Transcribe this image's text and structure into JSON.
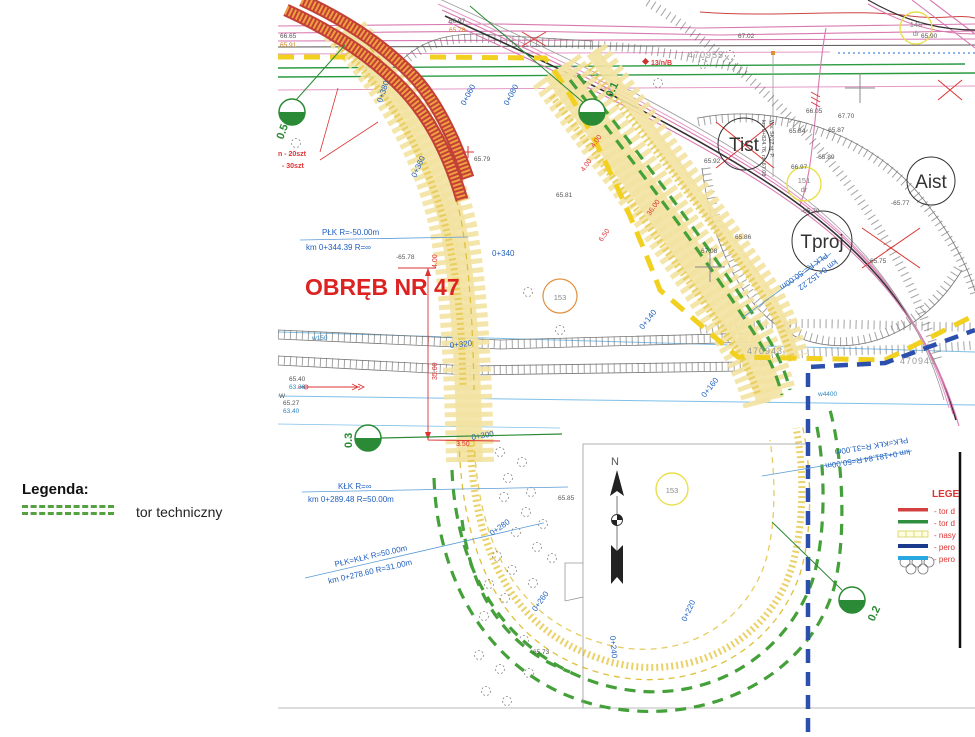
{
  "legend_left": {
    "title": "Legenda:",
    "item": "tor techniczny",
    "line_color": "#55a040"
  },
  "legend_box": {
    "title": "LEGE",
    "entries": [
      {
        "label": "- tor d",
        "color": "#d34040"
      },
      {
        "label": "- tor d",
        "color": "#2f8f3f"
      },
      {
        "label": "- nasy",
        "color": "#e8e04a"
      },
      {
        "label": "- pero",
        "color": "#1a3a8c"
      },
      {
        "label": "- pero",
        "color": "#28a8e0"
      }
    ]
  },
  "map": {
    "region_label": "OBRĘB NR 47",
    "north_label": "N",
    "curve_notes": [
      {
        "l1": "PŁK   R=-50.00m",
        "l2": "km 0+344.39   R=∞"
      },
      {
        "l1": "KŁK   R=∞",
        "l2": "km 0+289.48   R=50.00m"
      },
      {
        "l1": "PŁK=KŁK   R=50.00m",
        "l2": "km 0+278.60   R=31.00m"
      },
      {
        "l1": "PŁK=KŁK   R=31.00m",
        "l2": "km 0+181.84   R=50.00m"
      },
      {
        "l1": "PŁK   R=-50.00m",
        "l2": "km 0+152.22"
      }
    ],
    "chainages": [
      "0+380",
      "0+360",
      "0+340",
      "0+320",
      "0+300",
      "0+280",
      "0+260",
      "0+240",
      "0+220",
      "0+160",
      "0+140",
      "0+080",
      "0+060"
    ],
    "markers": [
      "0.5",
      "0.1",
      "0.3",
      "0.2"
    ],
    "big_circles": [
      "Tist",
      "Aist",
      "Tproj"
    ],
    "small_circles": [
      {
        "n": "148",
        "s": "dr"
      },
      {
        "n": "151",
        "s": "dr"
      },
      {
        "n": "153"
      },
      {
        "n": "153"
      }
    ],
    "parcel_ids": [
      "470955",
      "470943",
      "470943"
    ],
    "elevations": [
      "66.65",
      "65.91",
      "66.97",
      "65.78",
      "65.90",
      "67.02",
      "66.05",
      "65.84",
      "-65.87",
      "67.70",
      "-65.89",
      "65.92",
      "66.97",
      "-65.70",
      "-65.77",
      "65.86",
      "67.08",
      "65.75",
      "65.79",
      "-65.78",
      "65.40",
      "63.36",
      "65.27",
      "63.40",
      "65.85",
      "65.73",
      "65.81"
    ],
    "dimensions": [
      "35.00",
      "4.00",
      "3.50",
      "4.00",
      "4.00",
      "36.00",
      "6.50"
    ],
    "water_labels": [
      "w150",
      "w4400"
    ],
    "red_notes": [
      "n - 20szt",
      "- 30szt",
      "13/n/B"
    ],
    "pole_note_1": "Ws. SK17 st. P.",
    "pole_note_2": "km 0+824.76, rz. 67.08",
    "misc": {
      "w_letter": "W"
    }
  }
}
